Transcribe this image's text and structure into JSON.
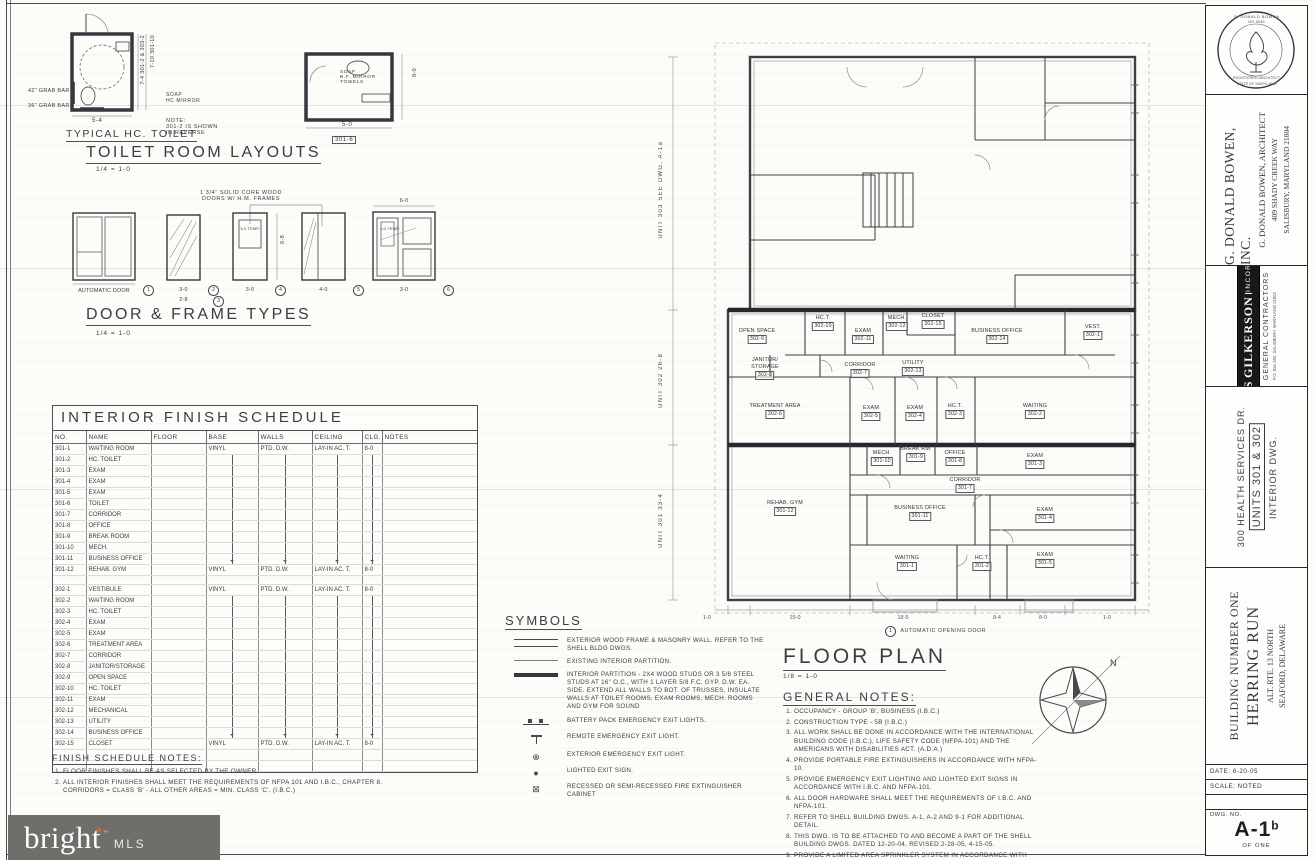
{
  "sheet": {
    "paper": "#fcfcf9",
    "ink": "#34373c",
    "accent_orange": "#e8612c"
  },
  "toilet_layouts": {
    "title": "TOILET ROOM LAYOUTS",
    "scale": "1/4 = 1-0",
    "subtitle": "TYPICAL HC. TOILET",
    "grab_bar_1": "42\" GRAB BAR",
    "grab_bar_2": "36\" GRAB BAR",
    "dim_width_1": "5-4",
    "side_dim_1": "7-4  301-2 & 303-2",
    "side_dim_2": "7-10  301-10",
    "soap_label": "SOAP\nHC MIRROR",
    "note": "NOTE:\n301-2 IS SHOWN\nIN REVERSE",
    "fixtures_label": "SOAP\nB.F. MIRROR\nTOWELS",
    "dim_width_2": "5-0",
    "side_dim_3": "8-0",
    "room_tag_2": "301-6"
  },
  "door_types": {
    "title": "DOOR & FRAME TYPES",
    "scale": "1/4 = 1-0",
    "head_note": "1 3/4\" SOLID CORE WOOD\nDOORS W/ H.M. FRAMES",
    "height_dim": "6-8",
    "items": [
      {
        "x": 73,
        "w": 62,
        "num": "1",
        "label": "AUTOMATIC DOOR"
      },
      {
        "x": 167,
        "w": 33,
        "num": "2",
        "num2": "3",
        "dim": "3-0",
        "dim2": "2-8"
      },
      {
        "x": 233,
        "w": 34,
        "num": "4",
        "dim": "3-0",
        "glass": "1/4 TEMP."
      },
      {
        "x": 302,
        "w": 43,
        "num": "5",
        "dim": "4-0"
      },
      {
        "x": 373,
        "w": 62,
        "num": "6",
        "dim": "3-0",
        "top_dim": "6-0",
        "glass": "1/4 TEMP."
      }
    ]
  },
  "finish_schedule": {
    "title": "INTERIOR FINISH SCHEDULE",
    "headers": [
      "NO.",
      "NAME",
      "FLOOR",
      "BASE",
      "WALLS",
      "CEILING",
      "CLG.",
      "NOTES"
    ],
    "group_301": [
      [
        "301-1",
        "WAITING ROOM",
        "",
        "VINYL",
        "PTD. D.W.",
        "LAY-IN AC. T.",
        "8-0",
        ""
      ],
      [
        "301-2",
        "HC. TOILET",
        "",
        "",
        "",
        "",
        "",
        ""
      ],
      [
        "301-3",
        "EXAM",
        "",
        "",
        "",
        "",
        "",
        ""
      ],
      [
        "301-4",
        "EXAM",
        "",
        "",
        "",
        "",
        "",
        ""
      ],
      [
        "301-5",
        "EXAM",
        "",
        "",
        "",
        "",
        "",
        ""
      ],
      [
        "301-6",
        "TOILET",
        "",
        "",
        "",
        "",
        "",
        ""
      ],
      [
        "301-7",
        "CORRIDOR",
        "",
        "",
        "",
        "",
        "",
        ""
      ],
      [
        "301-8",
        "OFFICE",
        "",
        "",
        "",
        "",
        "",
        ""
      ],
      [
        "301-9",
        "BREAK ROOM",
        "",
        "",
        "",
        "",
        "",
        ""
      ],
      [
        "301-10",
        "MECH.",
        "",
        "",
        "",
        "",
        "",
        ""
      ],
      [
        "301-11",
        "BUSINESS OFFICE",
        "",
        "",
        "",
        "",
        "",
        ""
      ],
      [
        "301-12",
        "REHAB. GYM",
        "",
        "VINYL",
        "PTD. D.W.",
        "LAY-IN AC. T.",
        "8-0",
        ""
      ]
    ],
    "group_302": [
      [
        "302-1",
        "VESTIBULE",
        "",
        "VINYL",
        "PTD. D.W.",
        "LAY-IN AC. T.",
        "8-0",
        ""
      ],
      [
        "302-2",
        "WAITING ROOM",
        "",
        "",
        "",
        "",
        "",
        ""
      ],
      [
        "302-3",
        "HC. TOILET",
        "",
        "",
        "",
        "",
        "",
        ""
      ],
      [
        "302-4",
        "EXAM",
        "",
        "",
        "",
        "",
        "",
        ""
      ],
      [
        "302-5",
        "EXAM",
        "",
        "",
        "",
        "",
        "",
        ""
      ],
      [
        "302-6",
        "TREATMENT AREA",
        "",
        "",
        "",
        "",
        "",
        ""
      ],
      [
        "302-7",
        "CORRIDOR",
        "",
        "",
        "",
        "",
        "",
        ""
      ],
      [
        "302-8",
        "JANITOR/STORAGE",
        "",
        "",
        "",
        "",
        "",
        ""
      ],
      [
        "302-9",
        "OPEN SPACE",
        "",
        "",
        "",
        "",
        "",
        ""
      ],
      [
        "302-10",
        "HC. TOILET",
        "",
        "",
        "",
        "",
        "",
        ""
      ],
      [
        "302-11",
        "EXAM",
        "",
        "",
        "",
        "",
        "",
        ""
      ],
      [
        "302-12",
        "MECHANICAL",
        "",
        "",
        "",
        "",
        "",
        ""
      ],
      [
        "302-13",
        "UTILITY",
        "",
        "",
        "",
        "",
        "",
        ""
      ],
      [
        "302-14",
        "BUSINESS OFFICE",
        "",
        "",
        "",
        "",
        "",
        ""
      ],
      [
        "302-15",
        "CLOSET",
        "",
        "VINYL",
        "PTD. D.W.",
        "LAY-IN AC. T.",
        "8-0",
        ""
      ]
    ]
  },
  "finish_notes": {
    "title": "FINISH SCHEDULE NOTES:",
    "items": [
      "FLOOR FINISHES SHALL BE AS SELECTED BY THE OWNER.",
      "ALL INTERIOR FINISHES SHALL MEET THE REQUIREMENTS OF NFPA 101 AND I.B.C., CHAPTER 8.\nCORRIDORS = CLASS 'B' - ALL OTHER AREAS = MIN. CLASS 'C'. (I.B.C.)"
    ]
  },
  "symbols": {
    "title": "SYMBOLS",
    "items": [
      {
        "glyph": "wall-double",
        "text": "EXTERIOR WOOD FRAME & MASONRY WALL. REFER TO THE SHELL BLDG DWGS."
      },
      {
        "glyph": "wall-single",
        "text": "EXISTING INTERIOR PARTITION."
      },
      {
        "glyph": "wall-thick",
        "text": "INTERIOR PARTITION - 2x4 WOOD STUDS OR 3 5/8 STEEL STUDS AT 16\" O.C., WITH 1 LAYER 5/8 F.C. GYP. D.W. EA. SIDE. EXTEND ALL WALLS TO BOT. OF TRUSSES, INSULATE WALLS AT TOILET ROOMS, EXAM ROOMS, MECH. ROOMS AND GYM FOR SOUND"
      },
      {
        "glyph": "battery",
        "text": "BATTERY PACK EMERGENCY EXIT LIGHTS."
      },
      {
        "glyph": "remote",
        "text": "REMOTE EMERGENCY EXIT LIGHT."
      },
      {
        "glyph": "circle-x",
        "text": "EXTERIOR EMERGENCY EXIT LIGHT."
      },
      {
        "glyph": "dot",
        "text": "LIGHTED EXIT SIGN."
      },
      {
        "glyph": "square-x",
        "text": "RECESSED OR SEMI-RECESSED FIRE EXTINGUISHER CABINET"
      }
    ]
  },
  "floor_plan": {
    "title": "FLOOR PLAN",
    "scale": "1/8 = 1-0",
    "north_label": "N",
    "auto_door_note": {
      "num": "1",
      "text": "AUTOMATIC OPENING DOOR"
    },
    "unit_dims": [
      {
        "label": "UNIT 303",
        "dim": "SEE DWG. A-1a",
        "top": 100
      },
      {
        "label": "UNIT 302",
        "dim": "26-8",
        "top": 290
      },
      {
        "label": "UNIT 301",
        "dim": "33-4",
        "top": 430
      }
    ],
    "bottom_dims": [
      {
        "v": "1-0",
        "x": 62
      },
      {
        "v": "15-0",
        "x": 150
      },
      {
        "v": "18-5",
        "x": 258
      },
      {
        "v": "8-4",
        "x": 352
      },
      {
        "v": "8-0",
        "x": 398
      },
      {
        "v": "1-0",
        "x": 462
      }
    ],
    "rooms": [
      {
        "name": "OPEN SPACE",
        "id": "302-9",
        "x": 112,
        "y": 303
      },
      {
        "name": "HC.T.",
        "id": "302-10",
        "x": 178,
        "y": 290
      },
      {
        "name": "EXAM",
        "id": "302-11",
        "x": 218,
        "y": 303
      },
      {
        "name": "MECH.",
        "id": "302-12",
        "x": 252,
        "y": 290
      },
      {
        "name": "CLOSET",
        "id": "302-15",
        "x": 288,
        "y": 288
      },
      {
        "name": "BUSINESS OFFICE",
        "id": "302-14",
        "x": 352,
        "y": 303
      },
      {
        "name": "VEST.",
        "id": "302-1",
        "x": 448,
        "y": 299
      },
      {
        "name": "JANITOR/\nSTORAGE",
        "id": "302-8",
        "x": 120,
        "y": 332
      },
      {
        "name": "CORRIDOR",
        "id": "302-7",
        "x": 215,
        "y": 337
      },
      {
        "name": "UTILITY",
        "id": "302-13",
        "x": 268,
        "y": 335
      },
      {
        "name": "TREATMENT AREA",
        "id": "302-6",
        "x": 130,
        "y": 378
      },
      {
        "name": "EXAM",
        "id": "302-5",
        "x": 226,
        "y": 380
      },
      {
        "name": "EXAM",
        "id": "302-4",
        "x": 270,
        "y": 380
      },
      {
        "name": "HC.T.",
        "id": "302-3",
        "x": 310,
        "y": 378
      },
      {
        "name": "WAITING",
        "id": "302-2",
        "x": 390,
        "y": 378
      },
      {
        "name": "REHAB. GYM",
        "id": "301-12",
        "x": 140,
        "y": 475
      },
      {
        "name": "MECH.",
        "id": "301-10",
        "x": 237,
        "y": 425
      },
      {
        "name": "BREAK RM.",
        "id": "301-9",
        "x": 271,
        "y": 421
      },
      {
        "name": "OFFICE",
        "id": "301-8",
        "x": 310,
        "y": 425
      },
      {
        "name": "EXAM",
        "id": "301-3",
        "x": 390,
        "y": 428
      },
      {
        "name": "CORRIDOR",
        "id": "301-7",
        "x": 320,
        "y": 452
      },
      {
        "name": "BUSINESS OFFICE",
        "id": "301-11",
        "x": 275,
        "y": 480
      },
      {
        "name": "EXAM",
        "id": "301-4",
        "x": 400,
        "y": 482
      },
      {
        "name": "EXAM",
        "id": "301-5",
        "x": 400,
        "y": 527
      },
      {
        "name": "WAITING",
        "id": "301-1",
        "x": 262,
        "y": 530
      },
      {
        "name": "HC.T.",
        "id": "301-2",
        "x": 337,
        "y": 530
      }
    ]
  },
  "general_notes": {
    "title": "GENERAL NOTES:",
    "items": [
      "OCCUPANCY - GROUP 'B', BUSINESS (I.B.C.)",
      "CONSTRUCTION TYPE - 5B (I.B.C.)",
      "ALL WORK SHALL BE DONE IN ACCORDANCE WITH THE INTERNATIONAL BUILDING CODE (I.B.C.), LIFE SAFETY CODE (NFPA-101) AND THE AMERICANS WITH DISABILITIES ACT. (A.D.A.)",
      "PROVIDE PORTABLE FIRE EXTINGUISHERS IN ACCORDANCE WITH NFPA-10.",
      "PROVIDE EMERGENCY EXIT LIGHTING AND LIGHTED EXIT SIGNS IN ACCORDANCE WITH I.B.C. AND NFPA-101.",
      "ALL DOOR HARDWARE SHALL MEET THE REQUIREMENTS OF I.B.C. AND NFPA-101.",
      "REFER TO SHELL BUILDING DWGS. A-1, A-2 AND 9-1 FOR ADDITIONAL DETAIL.",
      "THIS DWG. IS TO BE ATTACHED TO AND BECOME A PART OF THE SHELL BUILDING DWGS. DATED 12-20-04, REVISED 2-28-05, 4-15-05.",
      "PROVIDE A LIMITED AREA SPRINKLER SYSTEM IN ACCORDANCE WITH NFPA 13 & I.B.C. IN ROOMS 301-12, 302-8 & 302-12."
    ]
  },
  "title_block": {
    "seal": {
      "line1": "G. DONALD BOWEN",
      "line2": "NO. 5045",
      "line3": "REGISTERED ARCHITECT",
      "line4": "STATE OF MARYLAND"
    },
    "architect": {
      "name": "G. DONALD BOWEN, INC.",
      "sub": "G. DONALD BOWEN, ARCHITECT",
      "addr1": "409 SHADY CREEK WAY",
      "addr2": "SALISBURY, MARYLAND 21804"
    },
    "contractor": {
      "name1": "GILLIS",
      "name2": "GILKERSON",
      "name3": "INCORPORATED",
      "role": "GENERAL CONTRACTORS",
      "addr": "P.O. Box 350, SALISBURY, MARYLAND 21803"
    },
    "project": {
      "line1": "300 HEALTH SERVICES DR.",
      "line2": "UNITS 301 & 302",
      "line3": "INTERIOR DWG."
    },
    "building": {
      "line1": "BUILDING NUMBER ONE",
      "line2": "HERRING RUN",
      "line3": "ALT. RTE. 13 NORTH",
      "line4": "SEAFORD, DELAWARE"
    },
    "info": {
      "date": "DATE: 6-20-05",
      "scale": "SCALE: NOTED",
      "dwg_label": "DWG. NO.",
      "dwg_no": "A-1",
      "dwg_no_suffix": "b",
      "of": "OF ONE"
    }
  },
  "watermark": {
    "brand": "bright",
    "tm": "™",
    "star": "*",
    "mls": "MLS"
  }
}
